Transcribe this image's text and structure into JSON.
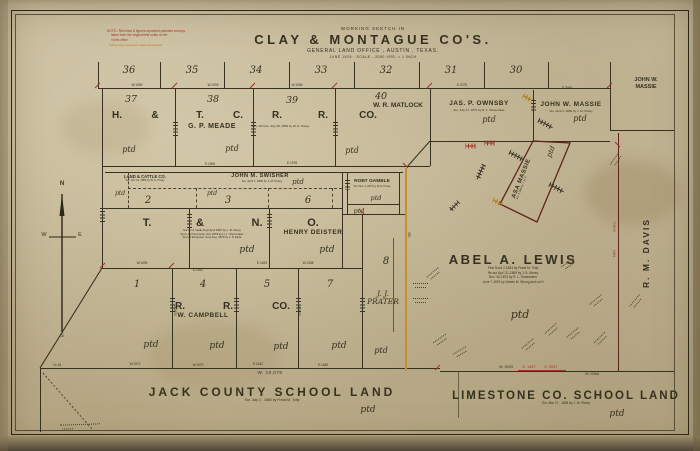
{
  "title": {
    "pre": "WORKING SKETCH IN",
    "main": "CLAY & MONTAGUE CO'S.",
    "sub": "GENERAL LAND OFFICE , AUSTIN , TEXAS.",
    "date_scale": "JUNE 1925 - SCALE - 2000 VRS. = 1 INCH"
  },
  "corner_note": {
    "lines": [
      "NOTE:- Red lines & figures represent patented surveys",
      "taken from the original field notes on file",
      "in this office.",
      "Yellow lines represent roads as traveled"
    ]
  },
  "tier1": {
    "numbers": [
      "36",
      "35",
      "34",
      "33",
      "32",
      "31",
      "30"
    ]
  },
  "tier2": {
    "numbers": [
      "37",
      "38",
      "39",
      "40"
    ],
    "company": [
      "H.",
      "&",
      "T.",
      "C.",
      "R.",
      "R.",
      "CO."
    ],
    "meade": "G. P. MEADE",
    "meade_note": "Surv. 4th Nov. July 28, 1883 by W. E. Posey",
    "matlock": "W. R. MATLOCK"
  },
  "north_strip": {
    "ownsby": "JAS. P. OWNSBY",
    "ownsby_note": "Sur. July 27, 1873 by R. L. Shoemaker",
    "massie": "JOHN W. MASSIE",
    "massie_note": "Sur. April 4, 1860 by J. M. Peavy"
  },
  "outside_east": {
    "massie_line1": "JOHN W.",
    "massie_line2": "MASSIE",
    "davis": "R. M. DAVIS"
  },
  "swisher_band": {
    "cattle_co": "LAND & CATTLE CO.",
    "cattle_note": "Sur. Oct. 21, 1883 by W. E. Posey",
    "swisher": "JOHN M. SWISHER",
    "swisher_note": "Sur. April 7, 1860 by J. M. Peavy"
  },
  "mid_row": {
    "numbers": [
      "2",
      "3",
      "6"
    ]
  },
  "tno": {
    "company": [
      "T.",
      "&",
      "N.",
      "O."
    ],
    "deister": "HENRY DEISTER",
    "notes": [
      "Sur's 1-6 made Aug't April 1887 by L. B. Abney",
      "Sur's 1-4 November July 1879 by H. L. Shoemaker",
      "Sur's 5 Extension June Aug. 1879 by J. P. Earle"
    ]
  },
  "gamble": {
    "name": "ROBT GAMBLE",
    "note": "Sur. Dec. 2, 1873 by W. E. Posey"
  },
  "section8": {
    "number": "8",
    "prater_line1": "J. J.",
    "prater_line2": "PRATER"
  },
  "lower_block": {
    "numbers": [
      "1",
      "4",
      "5",
      "7"
    ],
    "company": [
      "R.",
      "R.",
      "CO."
    ],
    "campbell": "W. CAMPBELL"
  },
  "lewis": {
    "name": "ABEL A. LEWIS",
    "notes": [
      "First Sur'd 2-1854 by Frank M. Totty",
      "Re-sur Apr'l 21-1869 by J. B. Abney",
      "Dec. 26-1873 by R. L. Shoemaker",
      "June 7-1876 by James M. Strong and cor'd"
    ]
  },
  "asa_massie": {
    "name": "ASA MASSIE",
    "note": "Sur. 4-1860 by J. M. P."
  },
  "schools": {
    "jack": "JACK COUNTY SCHOOL LAND",
    "jack_note": "Sur. July 2 - 1860 by Frank M. Totty",
    "limestone": "LIMESTONE CO. SCHOOL LAND",
    "limestone_note": "Sur. Mar 27 - 1854 by J. M. Peavy"
  },
  "compass": {
    "n": "N",
    "e": "E",
    "s": "S",
    "w": "W"
  },
  "ptd_label": "ptd",
  "measurements": {
    "w10078": "W. 10,078",
    "w9364": "W. 9364",
    "w5003": "W. 5003",
    "e1457": "E. 1457",
    "e3547": "E. 3547",
    "corner": "14.15",
    "ticks": [
      "W.1900",
      "W.1903",
      "W.1906",
      "E.2075",
      "E.3000",
      "E.1905",
      "E.1978",
      "W.1493",
      "E.1492",
      "E.1493",
      "W.1308",
      "W.1972",
      "W.1970",
      "E.1432",
      "E.1455",
      "5.2655",
      "5.2653",
      "5.5540",
      "1694",
      "350"
    ]
  },
  "colors": {
    "ink": "#35301f",
    "red": "#a63324",
    "maroon": "#5e241c",
    "road": "#c49033",
    "paper": "#c8bc9c"
  }
}
